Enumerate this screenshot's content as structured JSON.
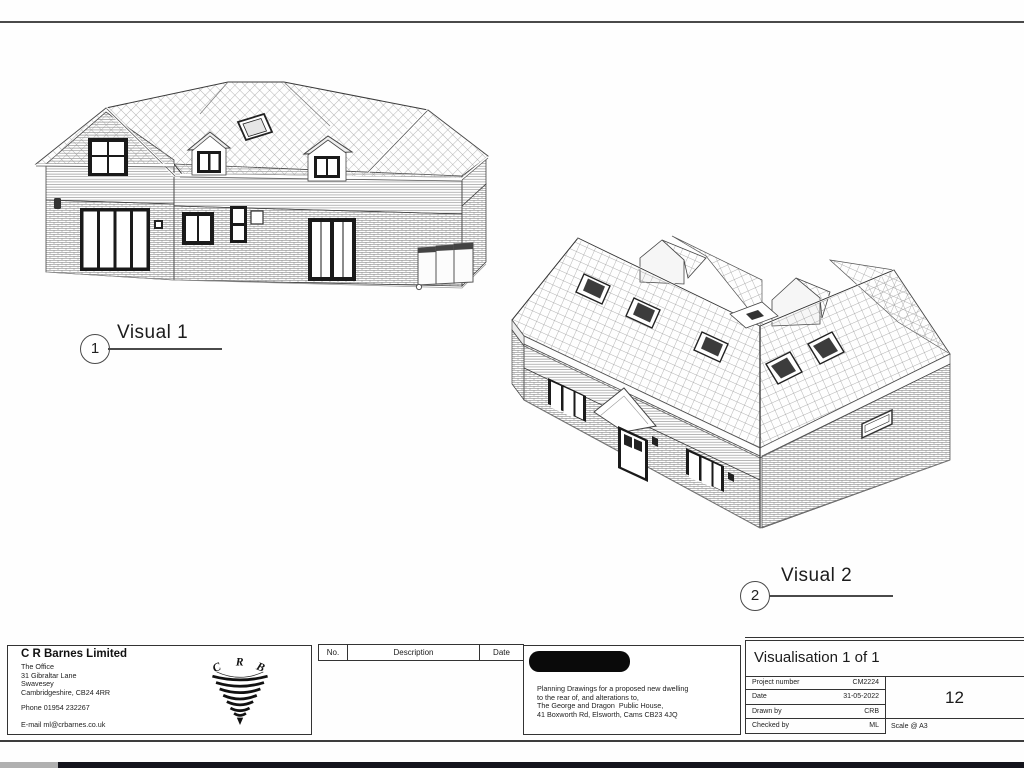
{
  "figures": [
    {
      "number": "1",
      "title": "Visual 1"
    },
    {
      "number": "2",
      "title": "Visual 2"
    }
  ],
  "company": {
    "name": "C R Barnes Limited",
    "address_lines": [
      "The Office",
      "31 Gibraltar Lane",
      "Swavesey",
      "Cambridgeshire, CB24 4RR"
    ],
    "phone": "Phone 01954 232267",
    "email": "E-mail ml@crbarnes.co.uk",
    "logo_letters": [
      "C",
      "R",
      "B"
    ]
  },
  "revision_table": {
    "headers": [
      "No.",
      "Description",
      "Date"
    ]
  },
  "project": {
    "description_lines": [
      "Planning Drawings for a proposed new dwelling",
      "to the rear of, and alterations to,",
      "The George and Dragon  Public House,",
      "41 Boxworth Rd, Elsworth, Cams CB23 4JQ"
    ]
  },
  "sheet": {
    "title": "Visualisation 1 of 1",
    "fields": [
      {
        "label": "Project number",
        "value": "CM2224"
      },
      {
        "label": "Date",
        "value": "31-05-2022"
      },
      {
        "label": "Drawn by",
        "value": "CRB"
      },
      {
        "label": "Checked by",
        "value": "ML"
      }
    ],
    "number": "12",
    "scale": "Scale @ A3"
  },
  "colors": {
    "line": "#333333",
    "redaction": "#0a0a0a",
    "page_edge_dark": "#14141c",
    "page_edge_light": "#b0b0b0"
  }
}
